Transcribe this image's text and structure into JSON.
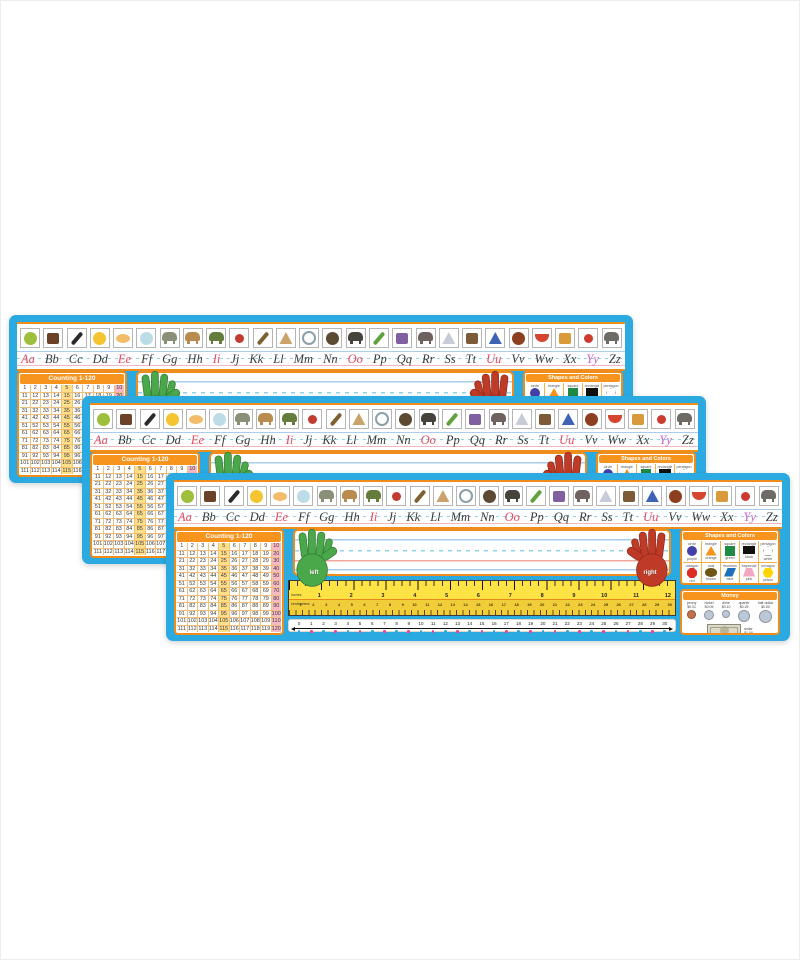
{
  "page": {
    "background": "#ffffff"
  },
  "colors": {
    "plate_blue": "#2baae2",
    "orange": "#f7941e",
    "border_orange": "#ef8d1c",
    "count_yellow": "#ffe089",
    "count_pink": "#f8b9c6",
    "ruler_yellow": "#ffe243",
    "dot_pink": "#f4408e",
    "dot_blue": "#2baae2",
    "hand_green": "#4aa84a",
    "hand_red": "#bf3a27"
  },
  "plates": [
    {
      "id": 1,
      "x": 9,
      "y": 315,
      "z": 1
    },
    {
      "id": 2,
      "x": 82,
      "y": 396,
      "z": 2
    },
    {
      "id": 3,
      "x": 166,
      "y": 473,
      "z": 3
    }
  ],
  "plate": {
    "alphabet": {
      "vowel_color": "#e8495f",
      "consonant_color": "#3b3b3b",
      "y_color": "#c95fc9",
      "letters": [
        {
          "pair": "Aa",
          "role": "vowel",
          "picture": "apple",
          "shape": "circle",
          "color": "#9ebf3b"
        },
        {
          "pair": "Bb",
          "role": "consonant",
          "picture": "books",
          "shape": "rect",
          "color": "#6b4226"
        },
        {
          "pair": "Cc",
          "role": "consonant",
          "picture": "crayon",
          "shape": "diag",
          "color": "#2b2b2b"
        },
        {
          "pair": "Dd",
          "role": "consonant",
          "picture": "duck",
          "shape": "circle",
          "color": "#f4c431"
        },
        {
          "pair": "Ee",
          "role": "vowel",
          "picture": "eggs",
          "shape": "pair",
          "color": "#f3bc6a"
        },
        {
          "pair": "Ff",
          "role": "consonant",
          "picture": "fishbowl",
          "shape": "bowl",
          "color": "#bcdde8"
        },
        {
          "pair": "Gg",
          "role": "consonant",
          "picture": "goat",
          "shape": "animal",
          "color": "#8a9078"
        },
        {
          "pair": "Hh",
          "role": "consonant",
          "picture": "horse",
          "shape": "animal",
          "color": "#b98b4e"
        },
        {
          "pair": "Ii",
          "role": "vowel",
          "picture": "iguana",
          "shape": "animal",
          "color": "#647c3c"
        },
        {
          "pair": "Jj",
          "role": "consonant",
          "picture": "jacks",
          "shape": "dot",
          "color": "#c23b2e"
        },
        {
          "pair": "Kk",
          "role": "consonant",
          "picture": "key",
          "shape": "diag",
          "color": "#7d6133"
        },
        {
          "pair": "Ll",
          "role": "consonant",
          "picture": "ladder",
          "shape": "triangle",
          "color": "#caa36a"
        },
        {
          "pair": "Mm",
          "role": "consonant",
          "picture": "magnifying-glass",
          "shape": "ring",
          "color": "#8aa0a8"
        },
        {
          "pair": "Nn",
          "role": "consonant",
          "picture": "nest",
          "shape": "circle",
          "color": "#5d4a33"
        },
        {
          "pair": "Oo",
          "role": "vowel",
          "picture": "ostrich",
          "shape": "animal",
          "color": "#46423c"
        },
        {
          "pair": "Pp",
          "role": "consonant",
          "picture": "peas",
          "shape": "diag",
          "color": "#61a23f"
        },
        {
          "pair": "Qq",
          "role": "consonant",
          "picture": "quilt",
          "shape": "rect",
          "color": "#8060a0"
        },
        {
          "pair": "Rr",
          "role": "consonant",
          "picture": "rhino",
          "shape": "animal",
          "color": "#6e625e"
        },
        {
          "pair": "Ss",
          "role": "consonant",
          "picture": "sailboat",
          "shape": "triangle",
          "color": "#c8ccd8"
        },
        {
          "pair": "Tt",
          "role": "consonant",
          "picture": "timer",
          "shape": "rect",
          "color": "#7d5a38"
        },
        {
          "pair": "Uu",
          "role": "vowel",
          "picture": "umbrella",
          "shape": "triangle",
          "color": "#3f63b5"
        },
        {
          "pair": "Vv",
          "role": "consonant",
          "picture": "violin",
          "shape": "circle",
          "color": "#8e3f20"
        },
        {
          "pair": "Ww",
          "role": "consonant",
          "picture": "watermelon",
          "shape": "wedge",
          "color": "#d6452f"
        },
        {
          "pair": "Xx",
          "role": "consonant",
          "picture": "xylophone",
          "shape": "rect",
          "color": "#d89a3a"
        },
        {
          "pair": "Yy",
          "role": "y",
          "picture": "yo-yo",
          "shape": "dot",
          "color": "#cf3a30"
        },
        {
          "pair": "Zz",
          "role": "consonant",
          "picture": "zebra",
          "shape": "animal",
          "color": "#6e6a66"
        }
      ]
    },
    "counting": {
      "title": "Counting 1-120",
      "numbers": [
        1,
        2,
        3,
        4,
        5,
        6,
        7,
        8,
        9,
        10,
        11,
        12,
        13,
        14,
        15,
        16,
        17,
        18,
        19,
        20,
        21,
        22,
        23,
        24,
        25,
        26,
        27,
        28,
        29,
        30,
        31,
        32,
        33,
        34,
        35,
        36,
        37,
        38,
        39,
        40,
        41,
        42,
        43,
        44,
        45,
        46,
        47,
        48,
        49,
        50,
        51,
        52,
        53,
        54,
        55,
        56,
        57,
        58,
        59,
        60,
        61,
        62,
        63,
        64,
        65,
        66,
        67,
        68,
        69,
        70,
        71,
        72,
        73,
        74,
        75,
        76,
        77,
        78,
        79,
        80,
        81,
        82,
        83,
        84,
        85,
        86,
        87,
        88,
        89,
        90,
        91,
        92,
        93,
        94,
        95,
        96,
        97,
        98,
        99,
        100,
        101,
        102,
        103,
        104,
        105,
        106,
        107,
        108,
        109,
        110,
        111,
        112,
        113,
        114,
        115,
        116,
        117,
        118,
        119,
        120
      ]
    },
    "name_area": {
      "left_hand": "left",
      "right_hand": "right"
    },
    "ruler": {
      "inches_label": "inches",
      "cm_label": "centimeters",
      "inches": [
        1,
        2,
        3,
        4,
        5,
        6,
        7,
        8,
        9,
        10,
        11,
        12
      ],
      "centimeters": [
        1,
        2,
        3,
        4,
        5,
        6,
        7,
        8,
        9,
        10,
        11,
        12,
        13,
        14,
        15,
        16,
        17,
        18,
        19,
        20,
        21,
        22,
        23,
        24,
        25,
        26,
        27,
        28,
        29,
        30
      ]
    },
    "number_line": {
      "numbers": [
        0,
        1,
        2,
        3,
        4,
        5,
        6,
        7,
        8,
        9,
        10,
        11,
        12,
        13,
        14,
        15,
        16,
        17,
        18,
        19,
        20,
        21,
        22,
        23,
        24,
        25,
        26,
        27,
        28,
        29,
        30
      ]
    },
    "shapes_panel": {
      "title": "Shapes and Colors",
      "cells": [
        {
          "shape_label": "circle",
          "color_label": "purple",
          "hex": "#4340a8",
          "shape": "circle"
        },
        {
          "shape_label": "triangle",
          "color_label": "orange",
          "hex": "#f7941e",
          "shape": "triangle"
        },
        {
          "shape_label": "square",
          "color_label": "green",
          "hex": "#1f8a43",
          "shape": "square"
        },
        {
          "shape_label": "rectangle",
          "color_label": "black",
          "hex": "#111111",
          "shape": "rectangle"
        },
        {
          "shape_label": "pentagon",
          "color_label": "white",
          "hex": "#ffffff",
          "shape": "pentagon"
        },
        {
          "shape_label": "octagon",
          "color_label": "red",
          "hex": "#dd2b26",
          "shape": "octagon"
        },
        {
          "shape_label": "oval",
          "color_label": "brown",
          "hex": "#6f5614",
          "shape": "oval"
        },
        {
          "shape_label": "rhombus",
          "color_label": "blue",
          "hex": "#1b6fbd",
          "shape": "rhombus"
        },
        {
          "shape_label": "trapezoid",
          "color_label": "pink",
          "hex": "#f4a7c3",
          "shape": "trapezoid"
        },
        {
          "shape_label": "hexagon",
          "color_label": "yellow",
          "hex": "#ffd400",
          "shape": "hexagon"
        }
      ]
    },
    "money_panel": {
      "title": "Money",
      "coins": [
        {
          "name": "penny",
          "value": "$0.01",
          "size": 9,
          "color": "#c4704b"
        },
        {
          "name": "nickel",
          "value": "$0.05",
          "size": 10,
          "color": "#bdc8d6"
        },
        {
          "name": "dime",
          "value": "$0.10",
          "size": 8,
          "color": "#bdc8d6"
        },
        {
          "name": "quarter",
          "value": "$0.25",
          "size": 12,
          "color": "#bdc8d6"
        },
        {
          "name": "half-dollar",
          "value": "$0.50",
          "size": 13,
          "color": "#bdc8d6"
        }
      ],
      "dollar": {
        "name": "dollar",
        "value": "$1.00"
      }
    }
  }
}
